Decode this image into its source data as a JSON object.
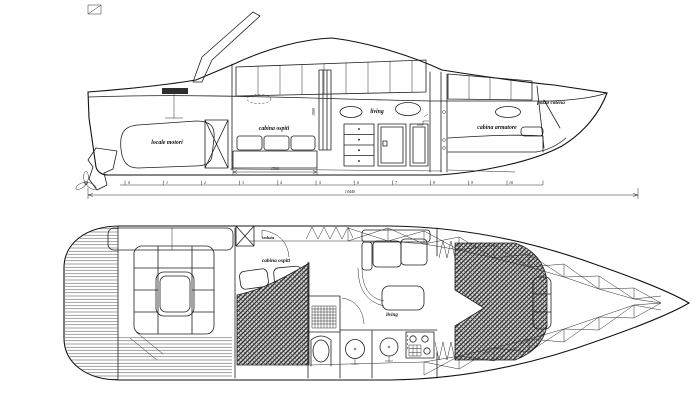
{
  "colors": {
    "ink": "#1f1f1f",
    "paper": "#ffffff",
    "carpet_fill": "#d8d8d8"
  },
  "profile": {
    "labels": {
      "engine_room": "locale motori",
      "guest_cabin": "cabina ospiti",
      "living": "living",
      "owner_cabin": "cabina armatore",
      "chain_locker": "pozzo catena"
    },
    "dims": {
      "guest_berth_length": "1500",
      "cabin_height": "1880",
      "overall_length": "10440"
    },
    "ruler": [
      "0",
      "1",
      "2",
      "3",
      "4",
      "5",
      "6",
      "7",
      "8",
      "9",
      "10"
    ]
  },
  "plan": {
    "labels": {
      "seat": "seduta",
      "guest_cabin": "cabina ospiti",
      "living": "living"
    }
  }
}
